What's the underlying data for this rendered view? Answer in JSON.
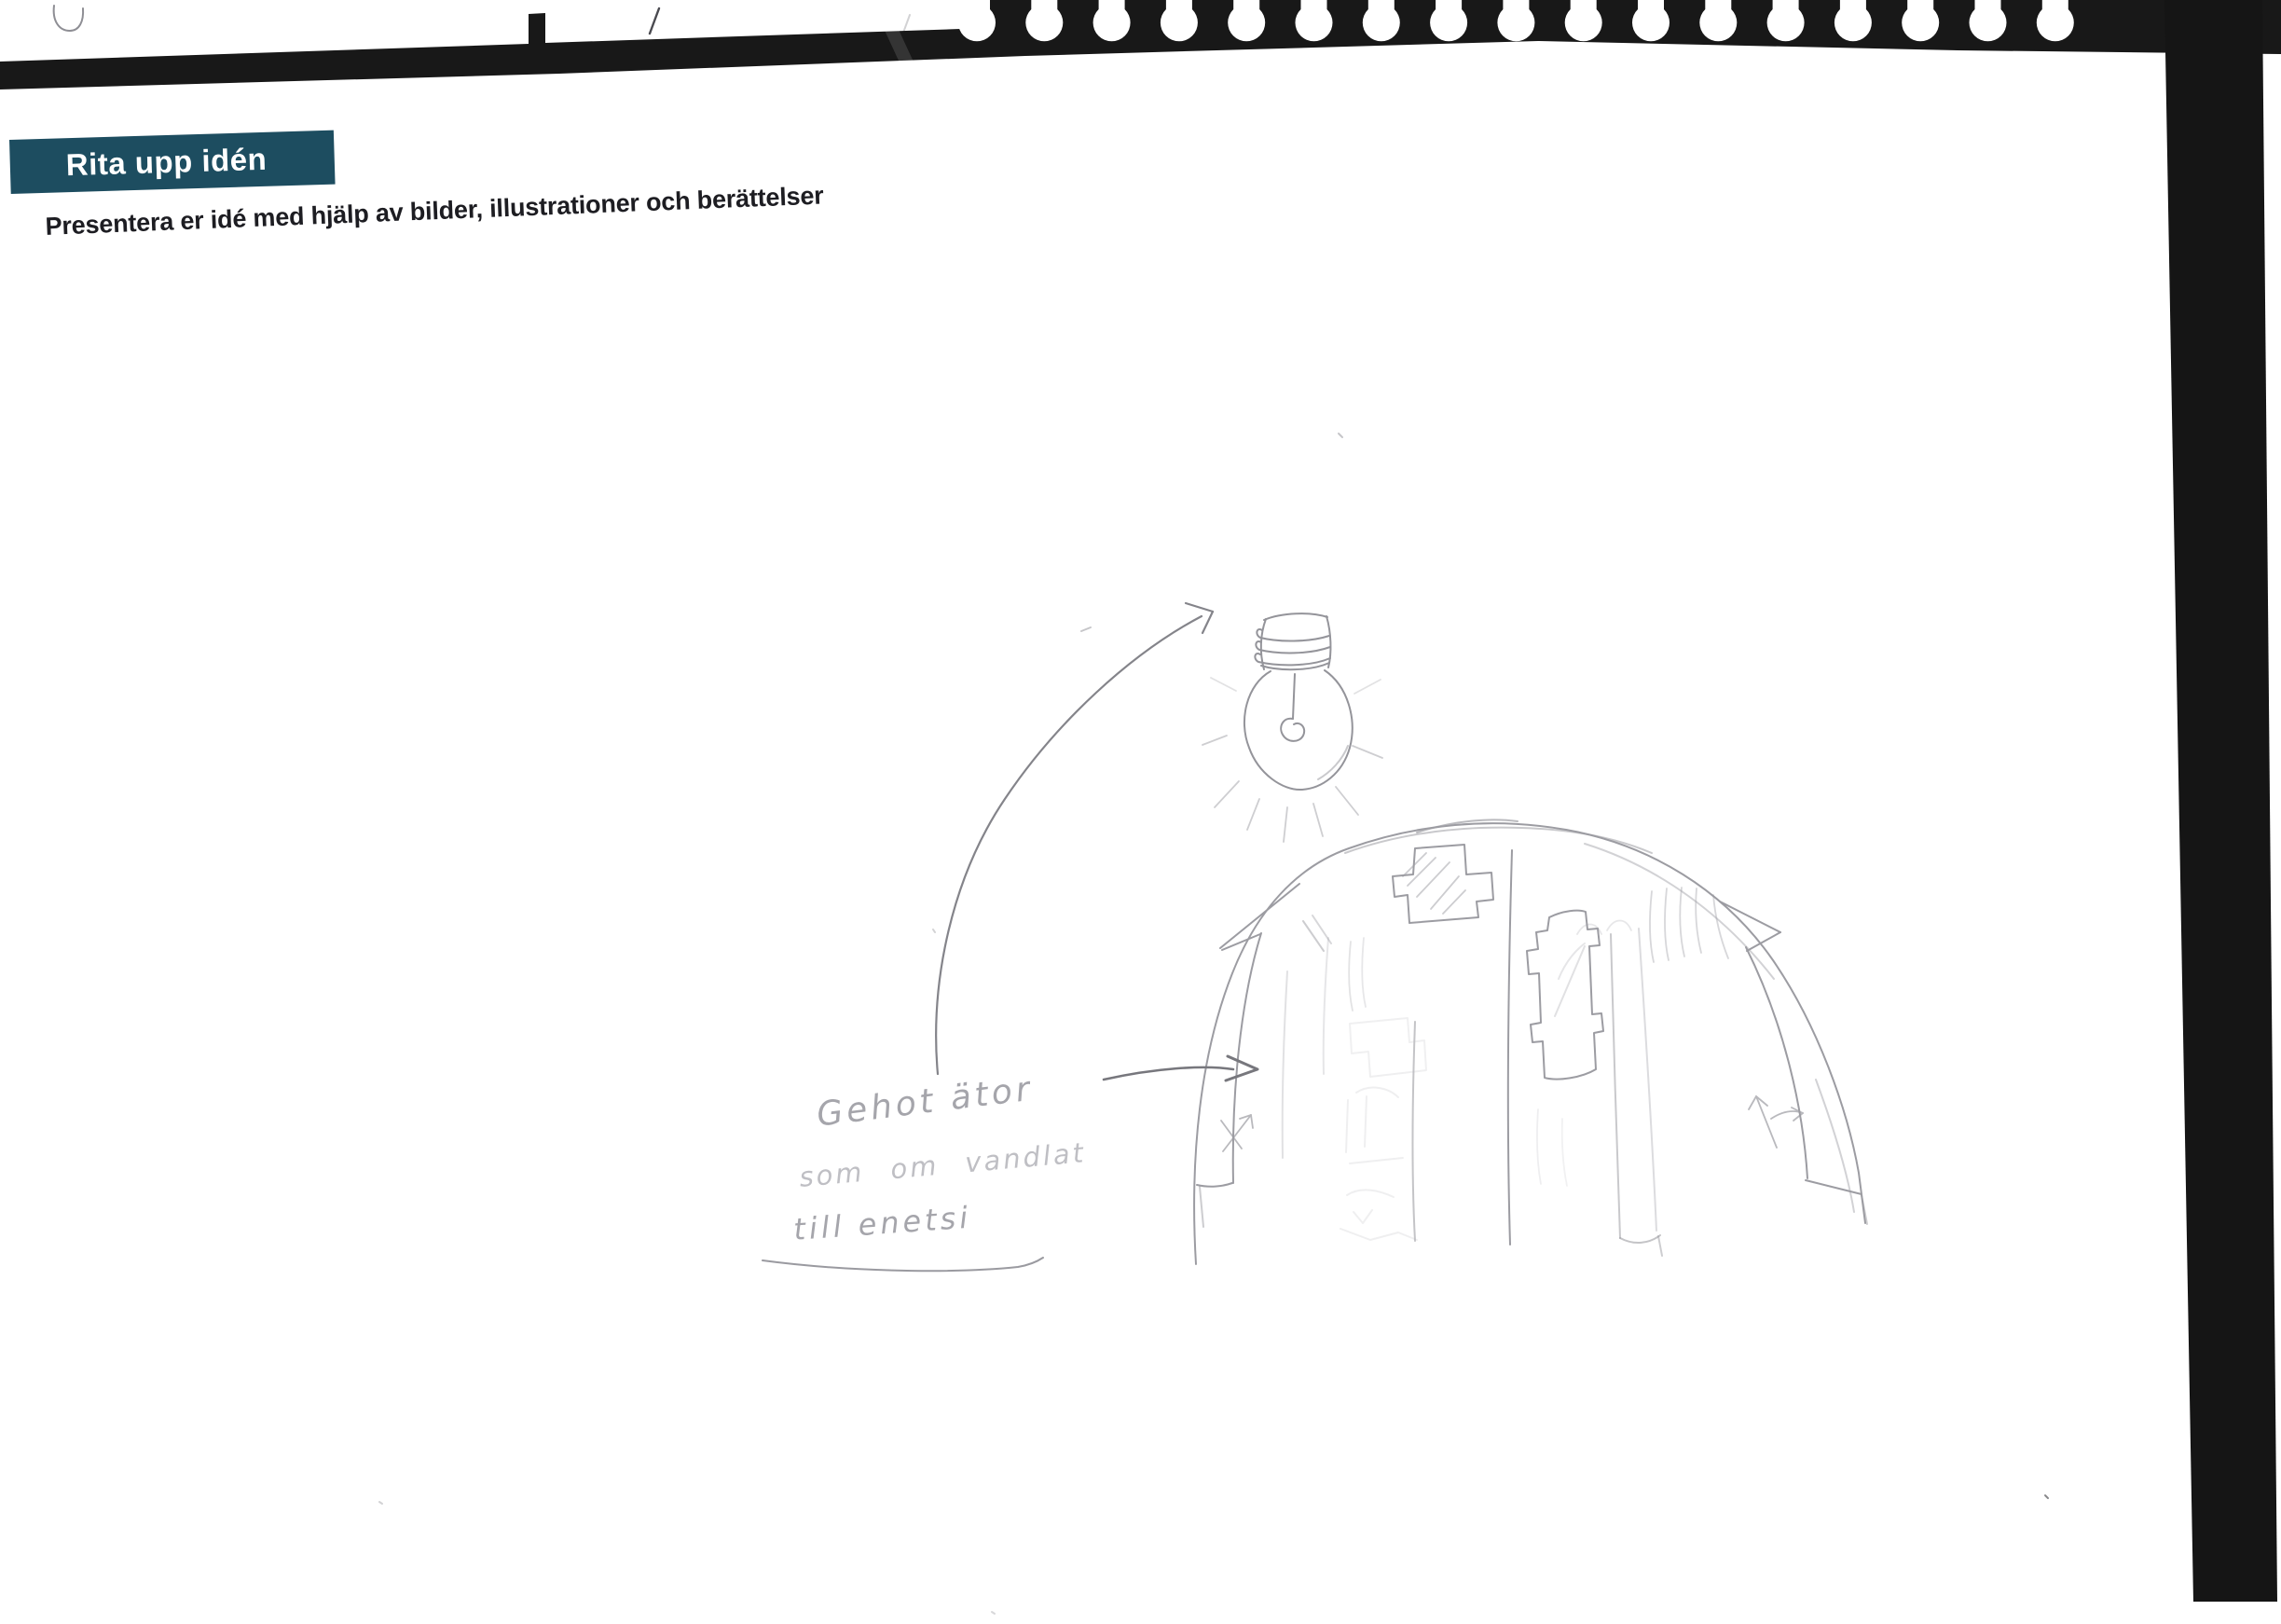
{
  "page": {
    "kind": "scanned worksheet page",
    "title": "Rita upp idén",
    "subtitle": "Presentera er idé med hjälp av bilder, illustrationer och berättelser"
  },
  "handwriting": {
    "line1": "Gehot ätor",
    "line2": "som om vandlat",
    "line3": "till enetsi"
  },
  "sketch": {
    "elements": [
      "light-bulb-with-rays",
      "curved-arrow-to-bulb",
      "dome-of-panels-with-puzzle-pieces",
      "arrow-to-dome",
      "underline-stroke"
    ]
  },
  "scan": {
    "binding_holes_count": 17,
    "colors": {
      "scan_black": "#181818",
      "accent_teal": "#1d4d60",
      "pencil_gray": "#9c9ca2",
      "paper_white": "#ffffff"
    }
  }
}
